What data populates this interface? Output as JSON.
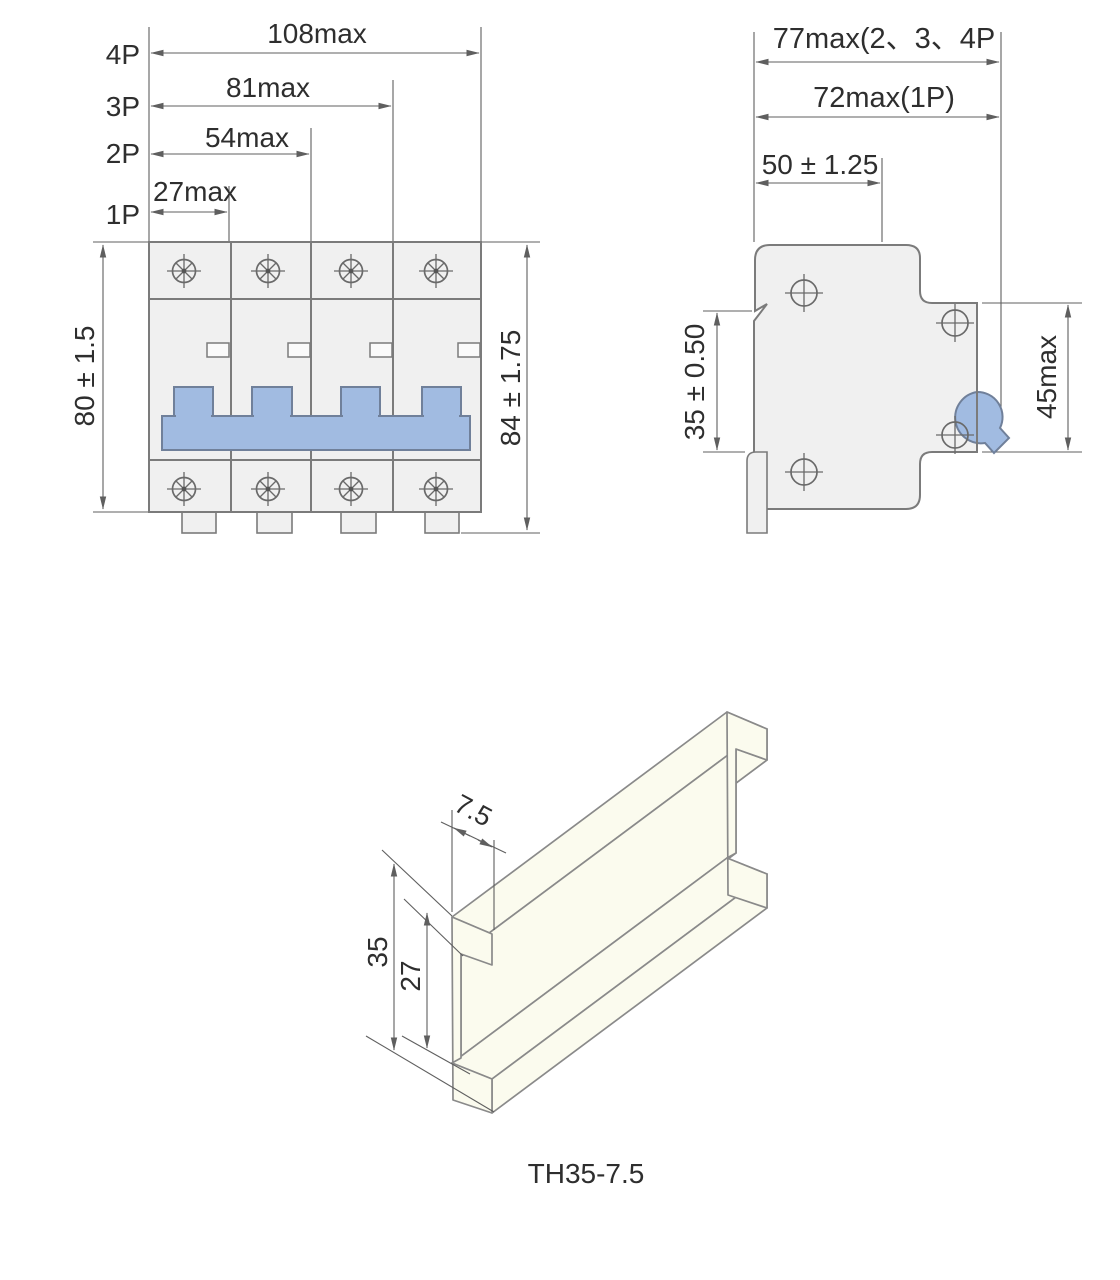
{
  "title": "Miniature circuit breaker outline and mounting dimension drawing",
  "front_view": {
    "pole_labels": [
      "4P",
      "3P",
      "2P",
      "1P"
    ],
    "width_dims": [
      "108max",
      "81max",
      "54max",
      "27max"
    ],
    "height_dim_left": "80 ± 1.5",
    "height_dim_right": "84 ± 1.75"
  },
  "side_view": {
    "overall_width_multi_pole": "77max(2、3、4P",
    "overall_width_single_pole": "72max(1P)",
    "mounting_depth": "50 ± 1.25",
    "rail_seat_dim": "35 ± 0.50",
    "front_height_dim": "45max"
  },
  "din_rail": {
    "depth_dim": "7.5",
    "overall_width_dim": "35",
    "inner_width_dim": "27",
    "type_label": "TH35-7.5"
  },
  "colors": {
    "body_fill": "#F0F0F0",
    "accent_blue": "#A1BBE1",
    "rail_fill": "#FBFBEE",
    "outline_gray": "#7B7B7B",
    "dimension_line": "#5F5F5F",
    "text": "#2E2E2E"
  }
}
